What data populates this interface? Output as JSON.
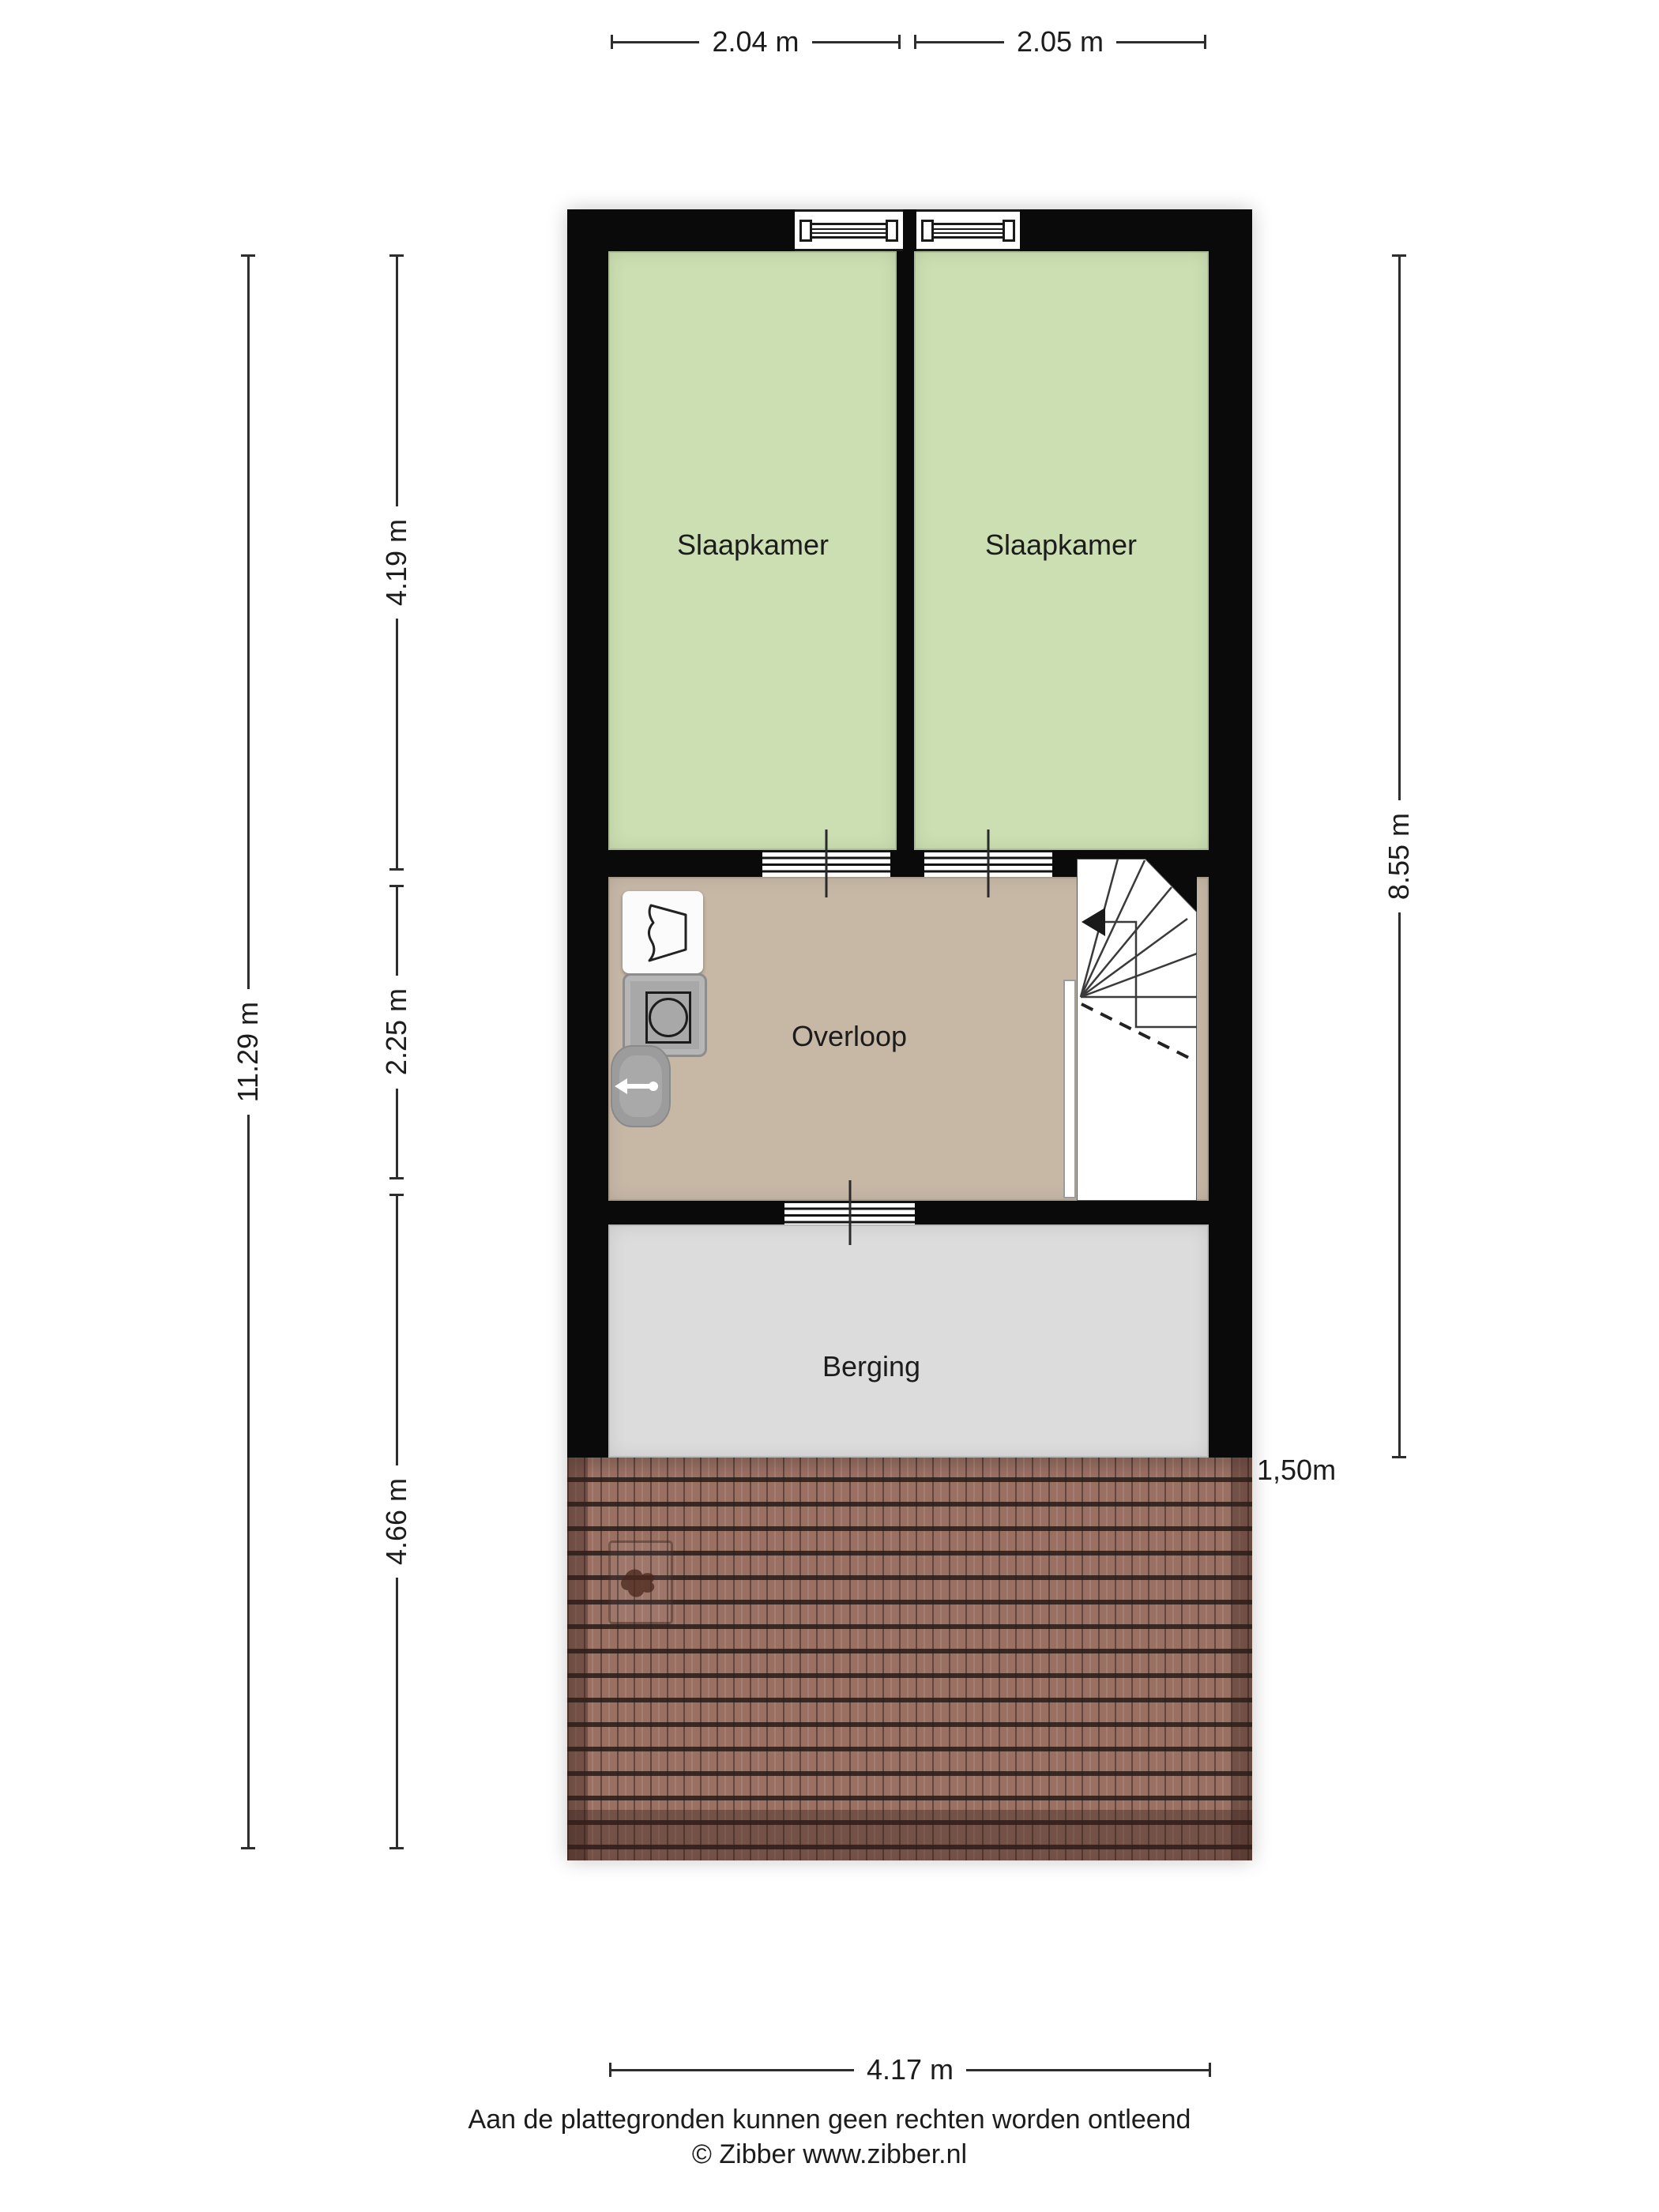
{
  "dimensions": {
    "top": [
      {
        "label": "2.04 m"
      },
      {
        "label": "2.05 m"
      }
    ],
    "left_total": "11.29 m",
    "left_segments": [
      "4.19 m",
      "2.25 m",
      "4.66 m"
    ],
    "right_total": "8.55 m",
    "bottom": "4.17 m",
    "roof_height_marker": "1,50m"
  },
  "rooms": [
    {
      "name": "slaapkamer-left",
      "label": "Slaapkamer",
      "floor_color": "#ccdfb2"
    },
    {
      "name": "slaapkamer-right",
      "label": "Slaapkamer",
      "floor_color": "#ccdfb2"
    },
    {
      "name": "overloop",
      "label": "Overloop",
      "floor_color": "#c7b8a6"
    },
    {
      "name": "berging",
      "label": "Berging",
      "floor_color": "#dcdcdc"
    }
  ],
  "icons": [
    {
      "name": "stairs-direction-arrow-icon"
    },
    {
      "name": "dryer-icon"
    },
    {
      "name": "washing-machine-icon"
    },
    {
      "name": "sink-icon"
    },
    {
      "name": "roof-window-icon"
    }
  ],
  "colors": {
    "wall": "#0a0a0a",
    "bedroom_floor": "#ccdfb2",
    "landing_floor": "#c7b8a6",
    "storage_floor": "#dcdcdc",
    "roof_tile": "#9a7063",
    "dimension_line": "#2e2e2e"
  },
  "footer": {
    "disclaimer": "Aan de plattegronden kunnen geen rechten worden ontleend",
    "copyright": "© Zibber www.zibber.nl"
  }
}
